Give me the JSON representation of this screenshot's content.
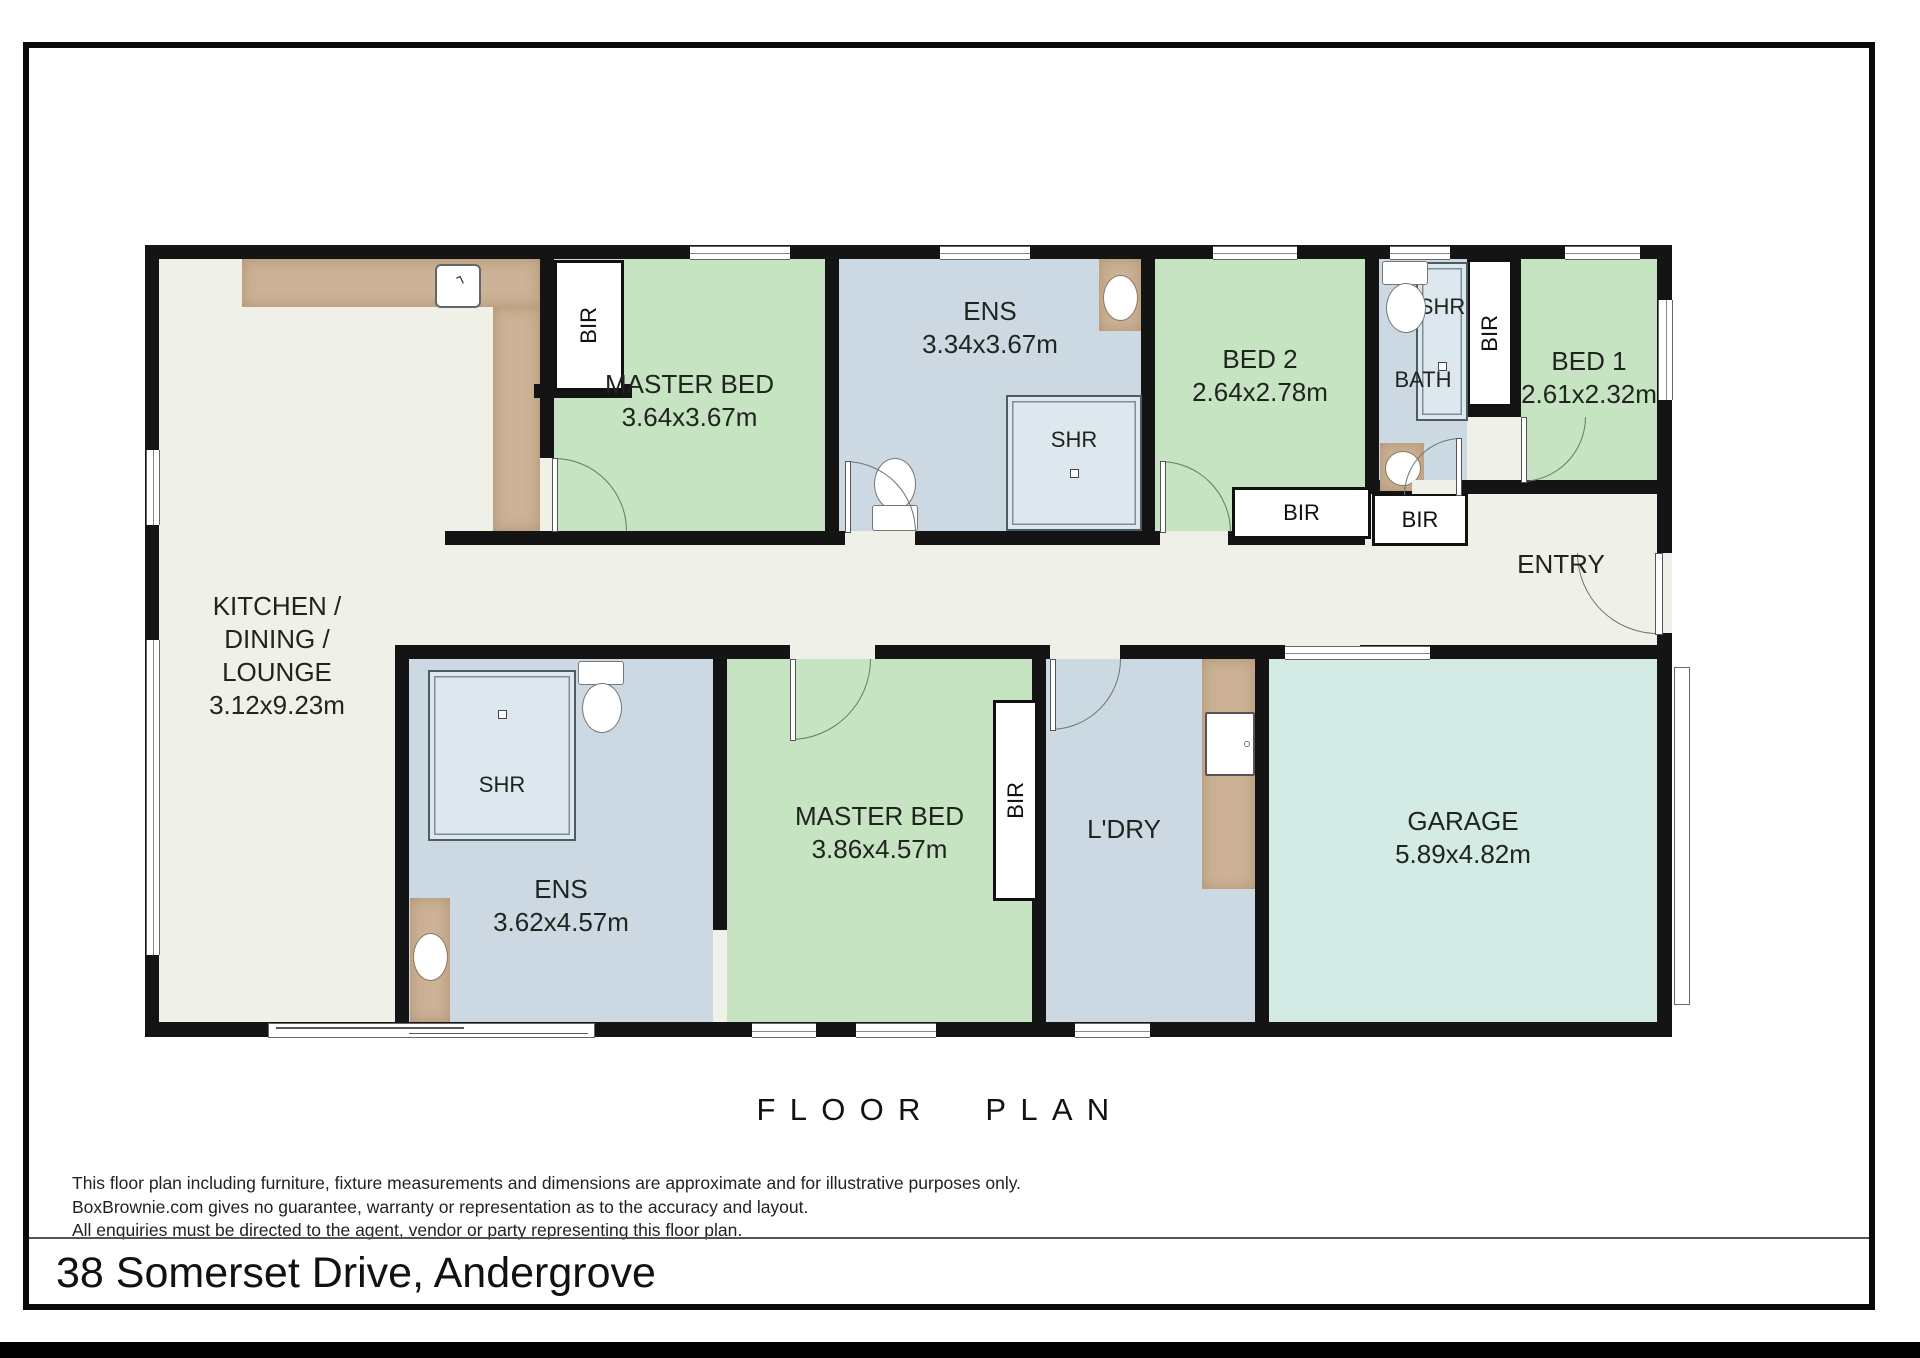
{
  "page": {
    "floor_plan_title": "FLOOR PLAN",
    "address": "38 Somerset Drive, Andergrove",
    "disclaimer": {
      "line1": "This floor plan including furniture, fixture measurements and dimensions are approximate and for illustrative purposes only.",
      "line2": "BoxBrownie.com gives no guarantee, warranty or representation as to the accuracy and layout.",
      "line3": "All enquiries must be directed to the agent, vendor or party representing this floor plan."
    }
  },
  "rooms": {
    "kitchen": {
      "name_line1": "KITCHEN /",
      "name_line2": "DINING /",
      "name_line3": "LOUNGE",
      "dims": "3.12x9.23m"
    },
    "master_bed_upper": {
      "name": "MASTER BED",
      "dims": "3.64x3.67m"
    },
    "ens_upper": {
      "name": "ENS",
      "dims": "3.34x3.67m"
    },
    "bed2": {
      "name": "BED 2",
      "dims": "2.64x2.78m"
    },
    "bath": {
      "name": "BATH"
    },
    "bed1": {
      "name": "BED 1",
      "dims": "2.61x2.32m"
    },
    "entry": {
      "name": "ENTRY"
    },
    "ens_lower": {
      "name": "ENS",
      "dims": "3.62x4.57m"
    },
    "master_bed_lower": {
      "name": "MASTER BED",
      "dims": "3.86x4.57m"
    },
    "laundry": {
      "name": "L'DRY"
    },
    "garage": {
      "name": "GARAGE",
      "dims": "5.89x4.82m"
    }
  },
  "labels": {
    "bir": "BIR",
    "shr": "SHR"
  },
  "colors": {
    "wall": "#141414",
    "floor": "#eff1e8",
    "bedroom_green": "#c6e3c2",
    "wet_area_blue": "#cdd9e2",
    "garage_cyan": "#d3eae5",
    "counter_tan": "#ccb296",
    "shower_blue": "#dce8ee",
    "page_background": "#ffffff"
  }
}
